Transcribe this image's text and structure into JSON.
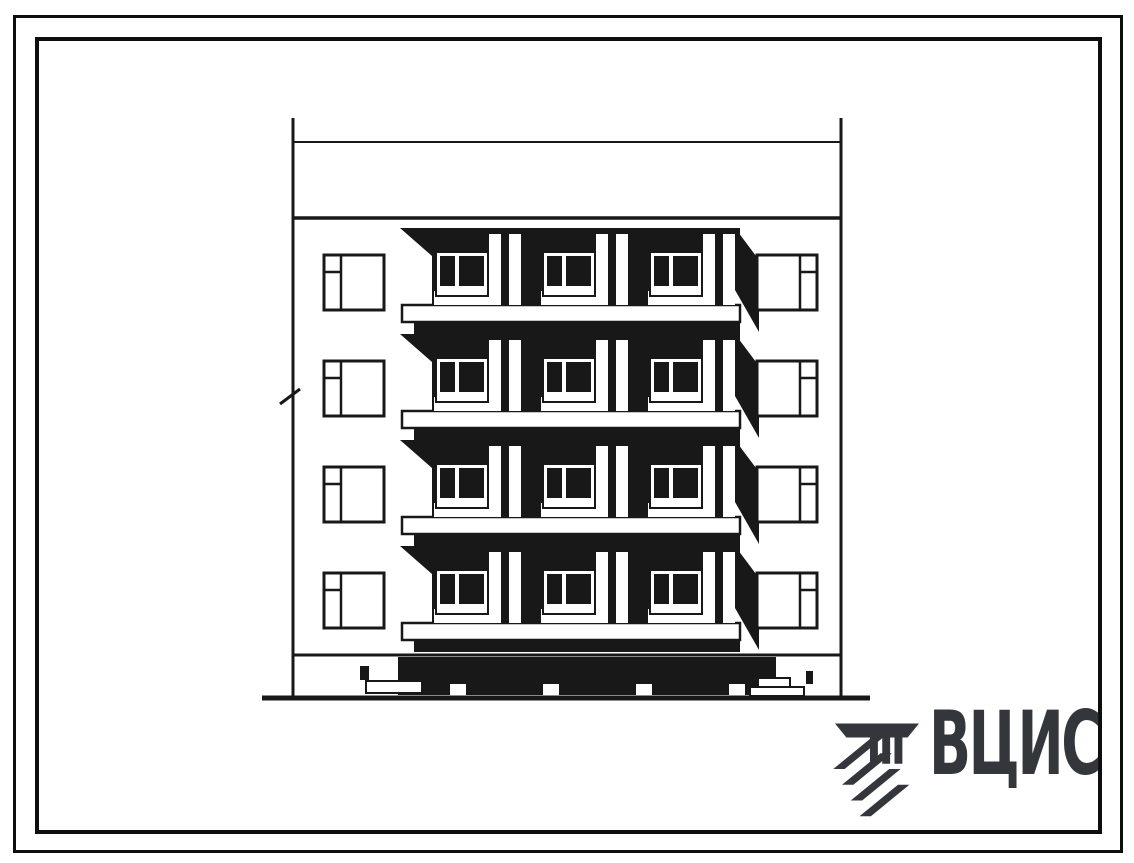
{
  "page": {
    "type": "scanned standard-design drawing sheet",
    "background": "#ffffff"
  },
  "drawing": {
    "ink_color": "#181818",
    "subject": "four-storey apartment block elevation with stacked balconies",
    "building": {
      "floors": 4,
      "balcony_columns": 3,
      "left_window_rows": 4,
      "right_window_rows": 4
    }
  },
  "logo": {
    "text": "ВЦИС",
    "color": "#33363b"
  }
}
